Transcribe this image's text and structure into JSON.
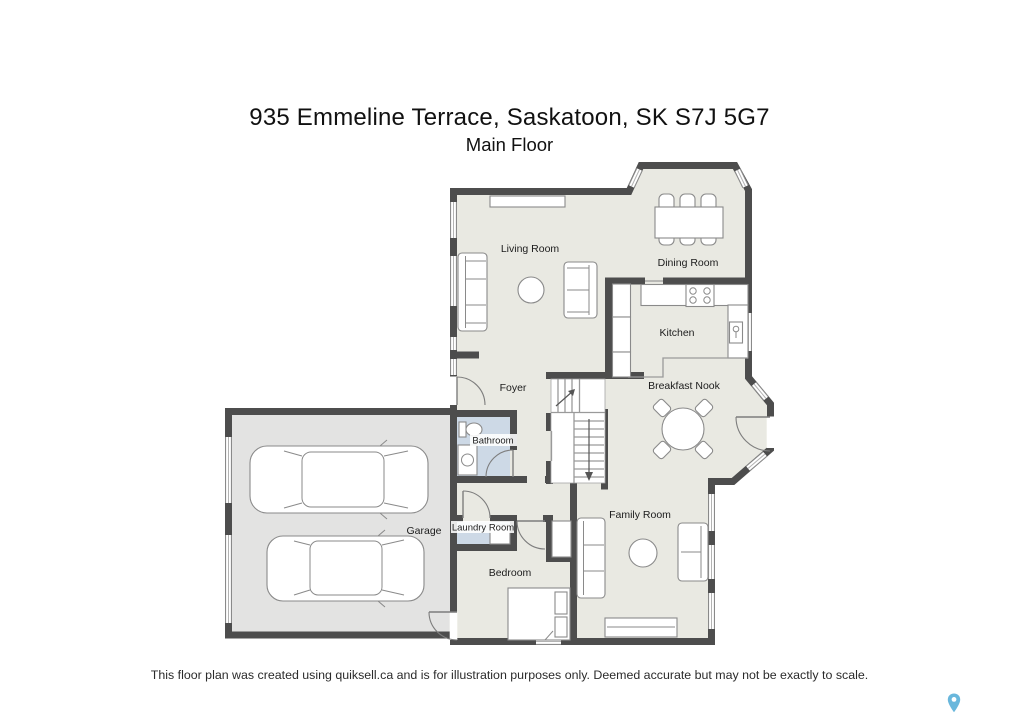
{
  "header": {
    "title": "935 Emmeline Terrace, Saskatoon, SK S7J 5G7",
    "subtitle": "Main Floor"
  },
  "floorplan": {
    "rooms": [
      {
        "id": "living-room",
        "label": "Living Room"
      },
      {
        "id": "dining-room",
        "label": "Dining Room"
      },
      {
        "id": "kitchen",
        "label": "Kitchen"
      },
      {
        "id": "breakfast-nook",
        "label": "Breakfast Nook"
      },
      {
        "id": "foyer",
        "label": "Foyer"
      },
      {
        "id": "bathroom",
        "label": "Bathroom"
      },
      {
        "id": "garage",
        "label": "Garage"
      },
      {
        "id": "laundry-room",
        "label": "Laundry Room"
      },
      {
        "id": "bedroom",
        "label": "Bedroom"
      },
      {
        "id": "family-room",
        "label": "Family Room"
      }
    ],
    "colors": {
      "wall": "#4d4d4d",
      "floor": "#e9e9e2",
      "garage_floor": "#e3e3e2",
      "wet_room": "#cdd9e6",
      "pin": "#69b7dc"
    }
  },
  "footer": {
    "disclaimer": "This floor plan was created using quiksell.ca and is for illustration purposes only. Deemed accurate but may not be exactly to scale."
  },
  "watermark": {
    "icon": "map-pin-icon"
  }
}
